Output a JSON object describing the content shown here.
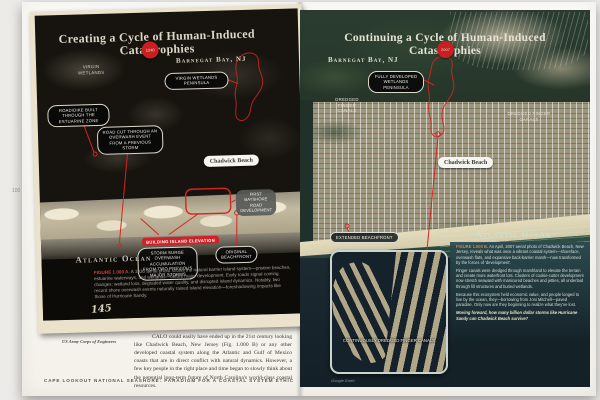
{
  "colors": {
    "accent_red": "#cf2127",
    "paper": "#f6f3ea",
    "photo_black": "#17130e",
    "sea_green": "#1d3431"
  },
  "left": {
    "title": "Creating a Cycle of Human-Induced Catastrophies",
    "year_badge": "1940",
    "location": "Barnegat Bay, NJ",
    "labels": {
      "virgin_wetlands": "Virgin Wetlands",
      "virgin_wetlands_peninsula": "Virgin Wetlands Peninsula",
      "road_dike": "Road/Dike built through the estuarine zone",
      "road_cut": "Road cut through an overwash event from a previous storm",
      "chadwick_beach": "Chadwick Beach",
      "first_bayshore": "First bayshore road development",
      "building_elevation": "Building Island Elevation",
      "storm_surge": "Storm surge overwash accumulation from two previous major storms",
      "original_beachfront": "Original beachfront",
      "ocean": "Atlantic Ocean"
    },
    "photo_number": "145",
    "caption_label": "FIGURE 1.000 A.",
    "caption_text": "A 1930 aerial photo shows the natural barrier island system—pristine beaches, estuarine waterways, and wetlands—before major development. Early roads signal coming changes: wetland loss, degraded water quality, and disrupted island dynamics. Notably, two record shore overwash events naturally raised island elevation—foreshadowing impacts like those of Hurricane Sandy.",
    "credit": "US Army Corps of Engineers",
    "page_number": "100",
    "body_text": "CALO could easily have ended up in the 21st century looking like Chadwick Beach, New Jersey (Fig. 1.000 B) or any other developed coastal system along the Atlantic and Gulf of Mexico coasts that are in direct conflict with natural dynamics. However, a few key people in the right place and time began to slowly think about the potential long-term future of North Carolina's world-class coastal resources.",
    "footer": "Cape Lookout National Seashore: Paradigm for a Coastal System Ethic"
  },
  "right": {
    "title": "Continuing a Cycle of Human-Induced Catastrophies",
    "year_badge": "2007",
    "location": "Barnegat Bay, NJ",
    "labels": {
      "fully_developed": "Fully developed wetlands peninsula",
      "dredged_left": "Dredged finger canals",
      "dredged_right": "Dredged finger canals",
      "chadwick_beach": "Chadwick Beach",
      "ocean": "Atlantic Ocean",
      "extended_beachfront": "Extended beachfront",
      "continuously_dredged": "Continuously dredged finger canals"
    },
    "caption_label": "FIGURE 1.000 B.",
    "caption_paragraphs": [
      "An April, 2007 aerial photo of Chadwick Beach, New Jersey, reveals what was once a vibrant coastal system—shoreface, overwash flats, and expansive back-barrier marsh—now transformed by the forces of 'development'.",
      "Finger canals were dredged through marshland to elevate the terrain and create more waterfront lots. Clusters of cookie-cutter development now stretch seaward with manicured beaches and jetties, all underlaid through fill structures and buried wetlands.",
      "Because this ecosystem held economic value, and people longed to live by the ocean, they—borrowing from Joni Mitchell—paved paradise. Only now are they beginning to realize what they've lost."
    ],
    "caption_question": "Moving forward, how many billion dollar storms like Hurricane Sandy can Chadwick Beach survive?",
    "credit": "Google Earth"
  }
}
